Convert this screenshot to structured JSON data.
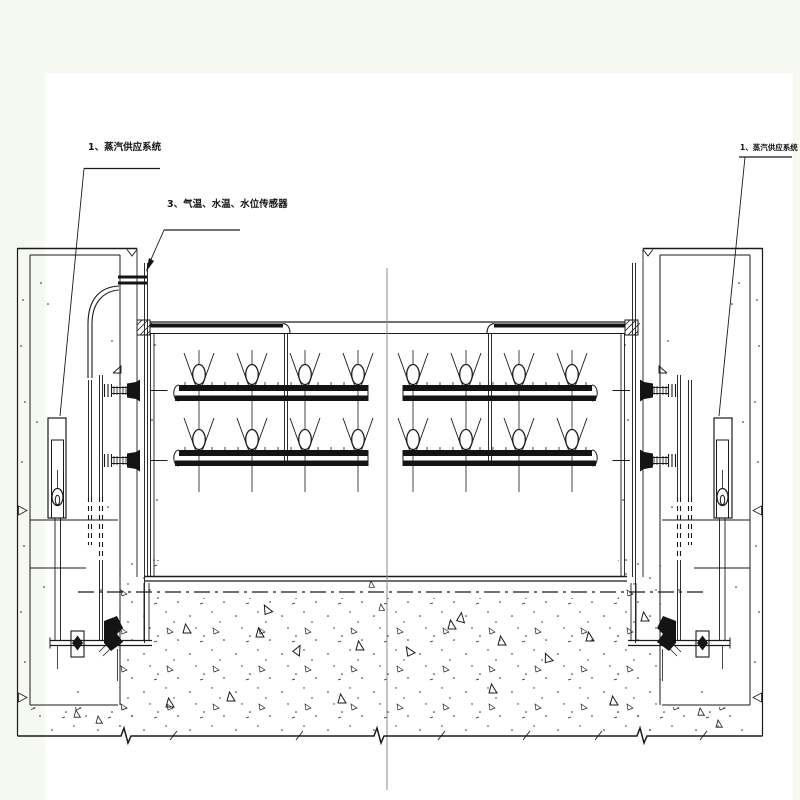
{
  "drawing": {
    "labels": {
      "steam_left": "1、蒸汽供应系统",
      "sensors": "3、气温、水温、水位传感器",
      "steam_right": "1、蒸汽供应系统"
    },
    "colors": {
      "background": "#f6f8f2",
      "canvas": "#ffffff",
      "line": "#1a1a1a",
      "centerline": "#8a8a8a"
    }
  }
}
